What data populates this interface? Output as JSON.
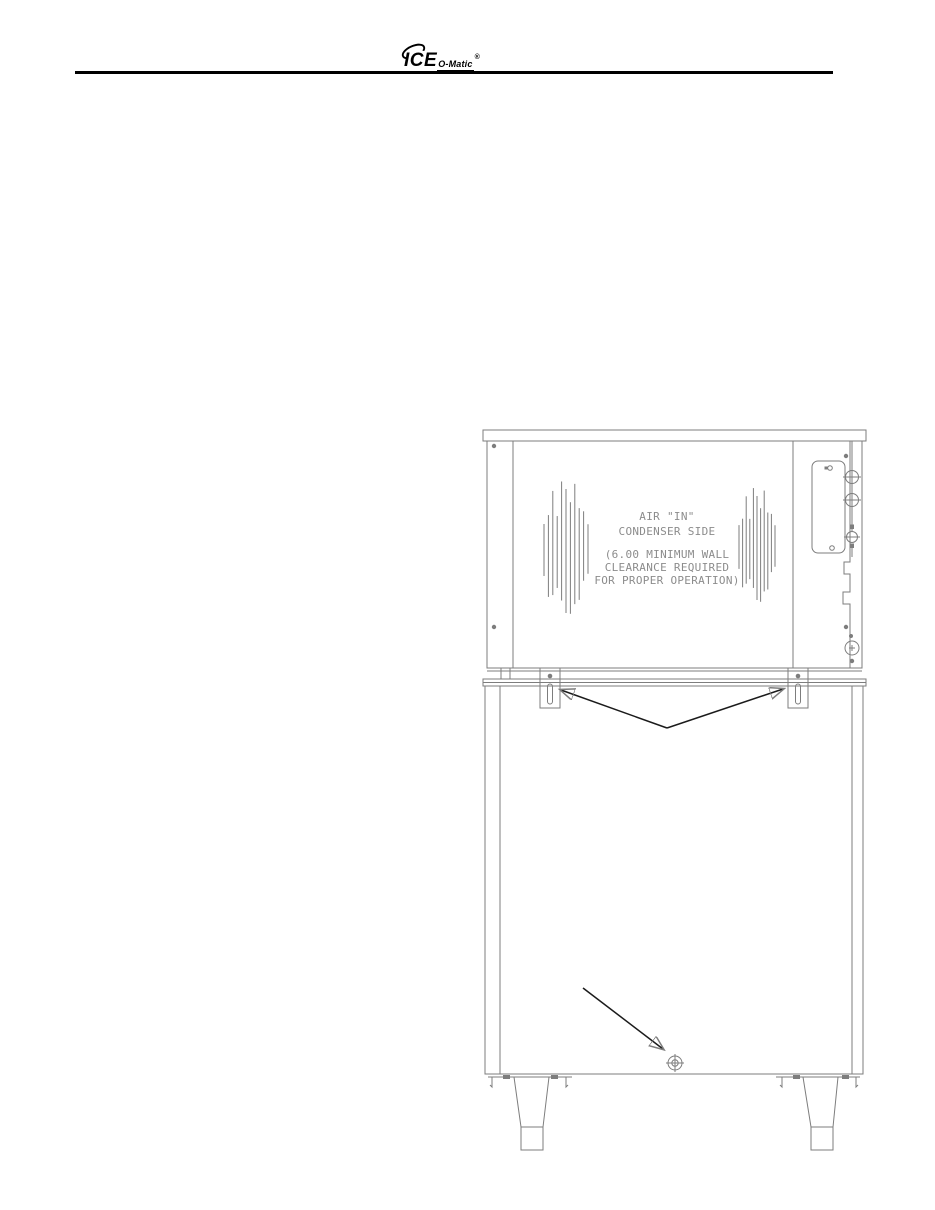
{
  "header": {
    "logo": {
      "main": "ICE",
      "sub": "O-Matic",
      "registered": "®"
    }
  },
  "drawing": {
    "labels": {
      "air_line1": "AIR \"IN\"",
      "air_line2": "CONDENSER SIDE",
      "note_line1": "(6.00 MINIMUM WALL",
      "note_line2": "CLEARANCE REQUIRED",
      "note_line3": "FOR PROPER OPERATION)"
    },
    "colors": {
      "line": "#7d7d7d",
      "text": "#8c8c8c",
      "arrow": "#1b1b1b",
      "brand": "#000000"
    }
  }
}
